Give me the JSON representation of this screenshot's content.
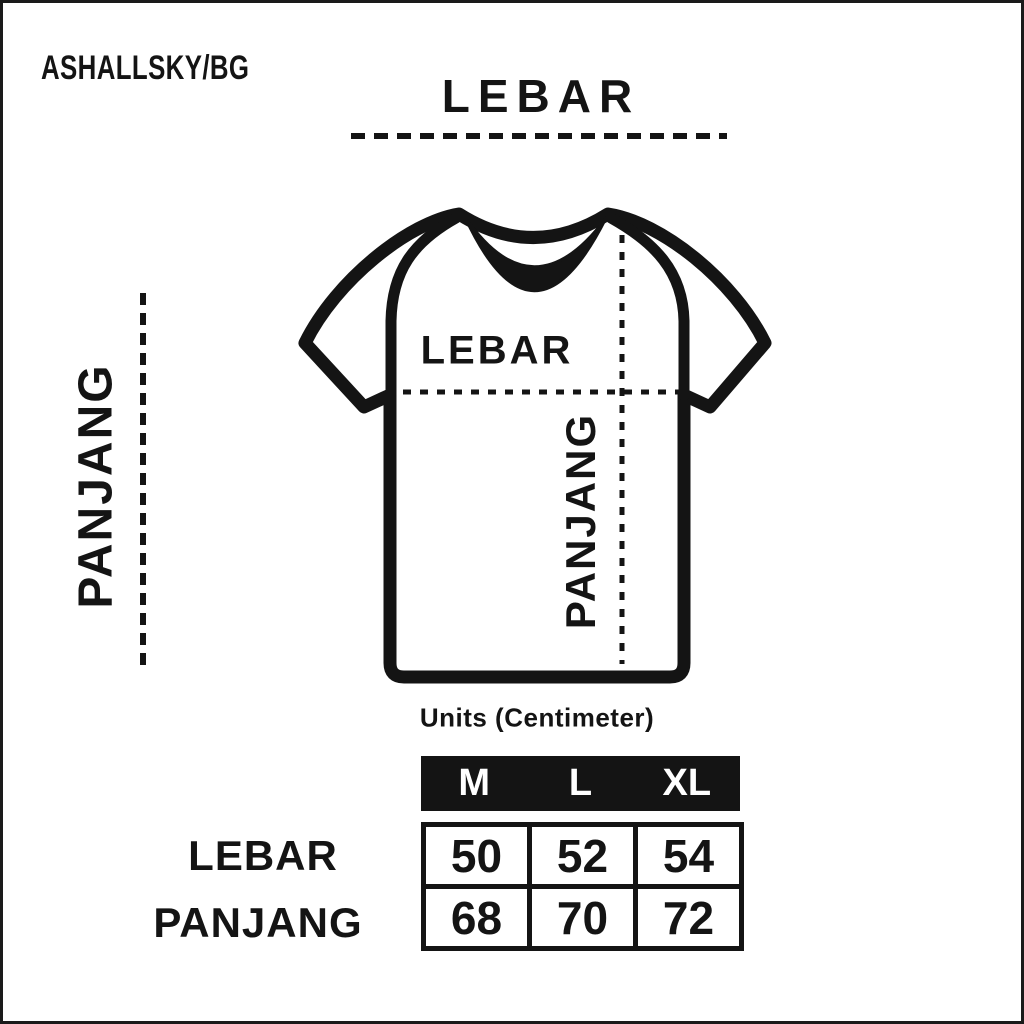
{
  "brand": "ASHALLSKY/BG",
  "colors": {
    "ink": "#141414",
    "background": "#ffffff",
    "header_text": "#ffffff"
  },
  "diagram": {
    "top_width_label": "LEBAR",
    "side_length_label": "PANJANG",
    "shirt_width_label": "LEBAR",
    "shirt_length_label": "PANJANG"
  },
  "units_label": "Units (Centimeter)",
  "size_table": {
    "columns": [
      "M",
      "L",
      "XL"
    ],
    "rows": [
      {
        "label": "LEBAR",
        "values": [
          "50",
          "52",
          "54"
        ]
      },
      {
        "label": "PANJANG",
        "values": [
          "68",
          "70",
          "72"
        ]
      }
    ]
  }
}
